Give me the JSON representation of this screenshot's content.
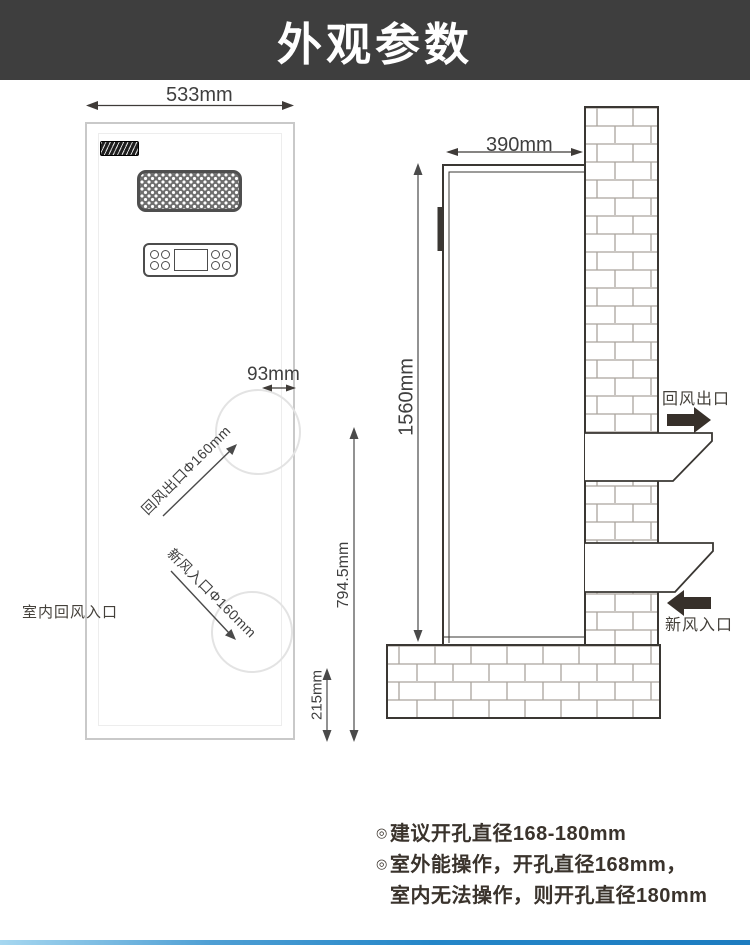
{
  "header": {
    "title": "外观参数"
  },
  "front_view": {
    "width_dim": "533mm",
    "side_offset_dim": "93mm",
    "return_outlet_dim": "回风出口Φ160mm",
    "fresh_inlet_dim": "新风入口Φ160mm",
    "indoor_return_label": "室内回风入口"
  },
  "side_view": {
    "depth_dim": "390mm",
    "height_dim": "1560mm",
    "outlet_height_dim": "794.5mm",
    "base_height_dim": "215mm",
    "return_outlet_label": "回风出口",
    "fresh_inlet_label": "新风入口"
  },
  "notes": {
    "bullet": "◎",
    "line1": "建议开孔直径168-180mm",
    "line2": "室外能操作，开孔直径168mm，",
    "line3": "室内无法操作，则开孔直径180mm"
  },
  "icons": {
    "outflow": "right-arrow-icon",
    "inflow": "left-arrow-icon"
  },
  "colors": {
    "header_bg": "#3e3e3e",
    "header_text": "#ffffff",
    "line_dark": "#3a3733",
    "line_light": "#c9c9c9",
    "dim_text": "#3f3f3f",
    "brick_mortar": "#aaa59e",
    "accent_bar_blue": "#2a86c7"
  }
}
